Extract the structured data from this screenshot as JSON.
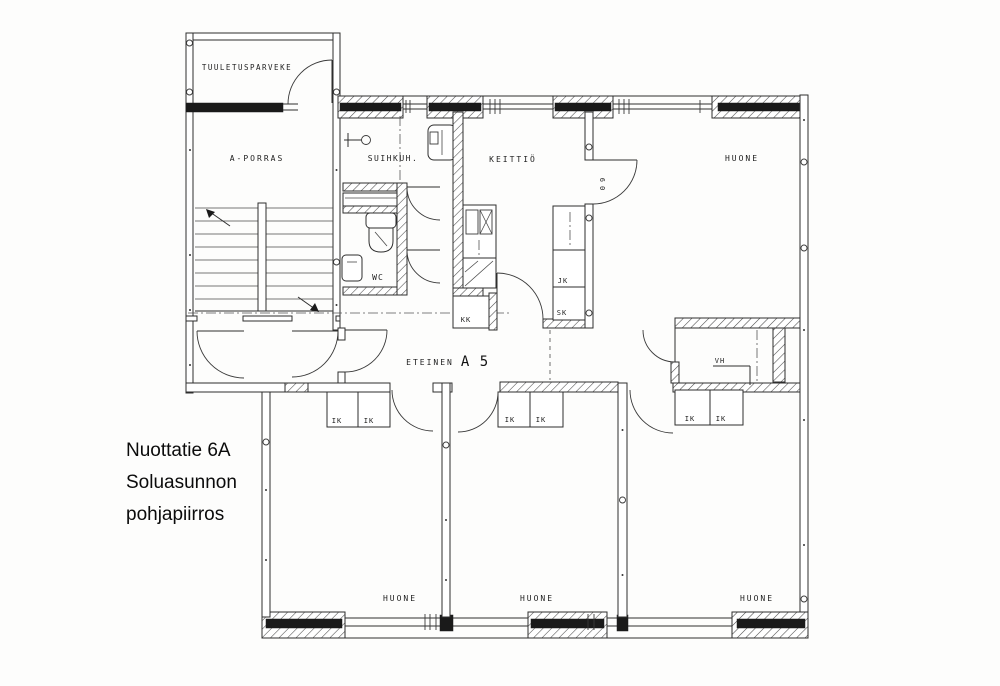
{
  "caption": {
    "line1": "Nuottatie 6A",
    "line2": "Soluasunnon",
    "line3": "pohjapiirros"
  },
  "rooms": {
    "balcony": "TUULETUSPARVEKE",
    "staircase": "A-PORRAS",
    "shower": "SUIHKUH.",
    "kitchen": "KEITTIÖ",
    "room": "HUONE",
    "wc": "WC",
    "hallway": "ETEINEN",
    "apartment_id": "A 5",
    "closet": "VH"
  },
  "cabinets": {
    "fridge": "JK",
    "cleaning_cupboard": "SK",
    "kitchenette": "KK",
    "wardrobe": "IK"
  },
  "door_width_mark": "60",
  "colors": {
    "paper": "#fdfdfc",
    "line": "#2e2e2e",
    "wall_fill": "#1a1a1a",
    "hatch": "#4a4a4a"
  }
}
